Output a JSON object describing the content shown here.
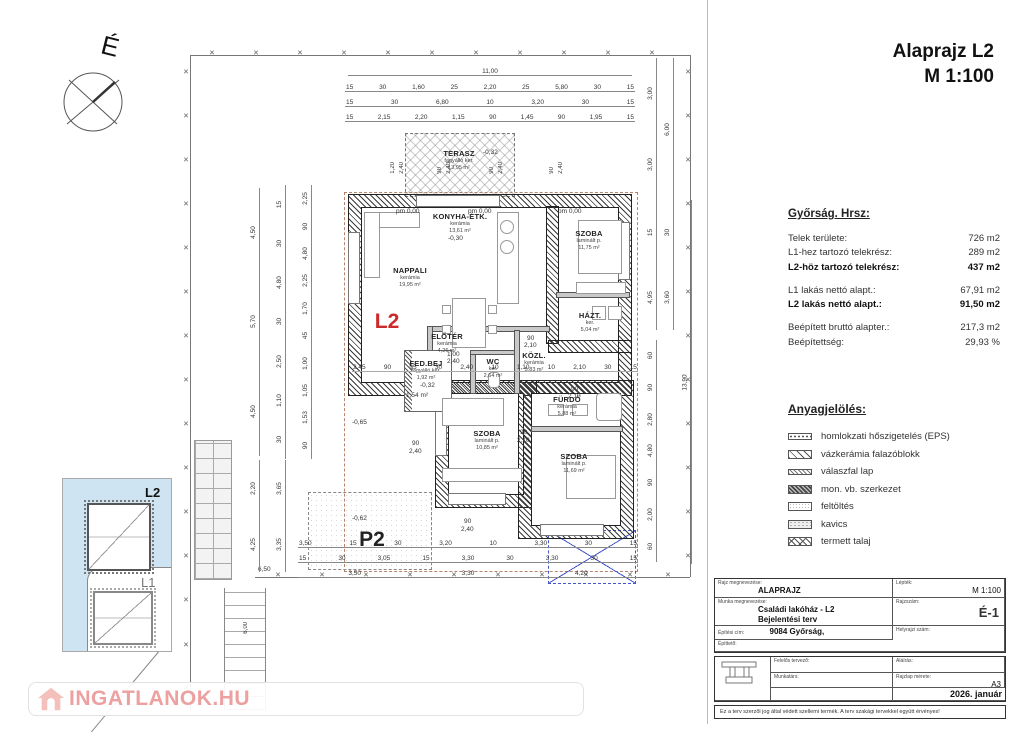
{
  "title": {
    "line1": "Alaprajz L2",
    "line2": "M 1:100"
  },
  "compass": {
    "north_label": "É"
  },
  "plan": {
    "unit_label": "L2",
    "parking_label": "P2",
    "rooms": [
      {
        "x": 459,
        "y": 160,
        "lines": [
          "TERASZ",
          "fagyálló ker.",
          "13,95 m²"
        ]
      },
      {
        "x": 410,
        "y": 277,
        "lines": [
          "NAPPALI",
          "kerámia",
          "19,95 m²"
        ]
      },
      {
        "x": 460,
        "y": 223,
        "lines": [
          "KONYHA-ÉTK.",
          "kerámia",
          "13,61 m²"
        ]
      },
      {
        "x": 589,
        "y": 240,
        "lines": [
          "SZOBA",
          "laminált p.",
          "11,75 m²"
        ]
      },
      {
        "x": 447,
        "y": 343,
        "lines": [
          "ELŐTÉR",
          "kerámia",
          "4,26 m²"
        ]
      },
      {
        "x": 534,
        "y": 362,
        "lines": [
          "KÖZL.",
          "kerámia",
          "5,83 m²"
        ]
      },
      {
        "x": 590,
        "y": 322,
        "lines": [
          "HÁZT.",
          "ker.",
          "5,04 m²"
        ]
      },
      {
        "x": 493,
        "y": 368,
        "lines": [
          "WC",
          "ker.",
          "2,64 m²"
        ]
      },
      {
        "x": 567,
        "y": 406,
        "lines": [
          "FÜRDŐ",
          "kerámia",
          "5,88 m²"
        ]
      },
      {
        "x": 487,
        "y": 440,
        "lines": [
          "SZOBA",
          "laminált p.",
          "10,85 m²"
        ]
      },
      {
        "x": 574,
        "y": 463,
        "lines": [
          "SZOBA",
          "laminált p.",
          "11,69 m²"
        ]
      },
      {
        "x": 426,
        "y": 370,
        "lines": [
          "FED.BEJ",
          "fagyálló ker.",
          "1,92 m²"
        ]
      }
    ],
    "floats": [
      {
        "t": "pm 0,00",
        "x": 396,
        "y": 209
      },
      {
        "t": "pm 0,00",
        "x": 468,
        "y": 209
      },
      {
        "t": "pm 0,00",
        "x": 558,
        "y": 209
      },
      {
        "t": "-0,30",
        "x": 448,
        "y": 236
      },
      {
        "t": "-0,32",
        "x": 483,
        "y": 150
      },
      {
        "t": "-0,32",
        "x": 420,
        "y": 383
      },
      {
        "t": "-0,65",
        "x": 352,
        "y": 420
      },
      {
        "t": "-0,62",
        "x": 352,
        "y": 516
      },
      {
        "t": "1,54 m²",
        "x": 406,
        "y": 393
      },
      {
        "t": "1,00",
        "x": 447,
        "y": 352
      },
      {
        "t": "2,40",
        "x": 447,
        "y": 359
      },
      {
        "t": "90",
        "x": 527,
        "y": 336
      },
      {
        "t": "2,10",
        "x": 524,
        "y": 343
      },
      {
        "t": "90",
        "x": 571,
        "y": 387
      },
      {
        "t": "2,10",
        "x": 568,
        "y": 394
      },
      {
        "t": "90",
        "x": 412,
        "y": 441
      },
      {
        "t": "2,40",
        "x": 409,
        "y": 449
      },
      {
        "t": "90",
        "x": 520,
        "y": 430
      },
      {
        "t": "2,10",
        "x": 517,
        "y": 438
      },
      {
        "t": "90",
        "x": 464,
        "y": 519
      },
      {
        "t": "2,40",
        "x": 461,
        "y": 527
      },
      {
        "t": "6,50",
        "x": 258,
        "y": 567
      },
      {
        "t": "1,20",
        "x": 390,
        "y": 162,
        "c": "vflt"
      },
      {
        "t": "2,40",
        "x": 399,
        "y": 162,
        "c": "vflt"
      },
      {
        "t": "90",
        "x": 437,
        "y": 167,
        "c": "vflt"
      },
      {
        "t": "2,40",
        "x": 446,
        "y": 162,
        "c": "vflt"
      },
      {
        "t": "90",
        "x": 489,
        "y": 167,
        "c": "vflt"
      },
      {
        "t": "2,40",
        "x": 498,
        "y": 162,
        "c": "vflt"
      },
      {
        "t": "90",
        "x": 549,
        "y": 167,
        "c": "vflt"
      },
      {
        "t": "2,40",
        "x": 558,
        "y": 162,
        "c": "vflt"
      },
      {
        "t": "6,00",
        "x": 243,
        "y": 622,
        "c": "vflt"
      }
    ],
    "boundary_marks": [
      {
        "t": "×",
        "x": 186,
        "y": 72
      },
      {
        "t": "×",
        "x": 186,
        "y": 116
      },
      {
        "t": "×",
        "x": 186,
        "y": 160
      },
      {
        "t": "×",
        "x": 186,
        "y": 204
      },
      {
        "t": "×",
        "x": 186,
        "y": 248
      },
      {
        "t": "×",
        "x": 186,
        "y": 292
      },
      {
        "t": "×",
        "x": 186,
        "y": 336
      },
      {
        "t": "×",
        "x": 186,
        "y": 380
      },
      {
        "t": "×",
        "x": 186,
        "y": 424
      },
      {
        "t": "×",
        "x": 186,
        "y": 468
      },
      {
        "t": "×",
        "x": 186,
        "y": 512
      },
      {
        "t": "×",
        "x": 186,
        "y": 556
      },
      {
        "t": "×",
        "x": 186,
        "y": 600
      },
      {
        "t": "×",
        "x": 186,
        "y": 645
      },
      {
        "t": "×",
        "x": 186,
        "y": 688
      },
      {
        "t": "×",
        "x": 212,
        "y": 53
      },
      {
        "t": "×",
        "x": 256,
        "y": 53
      },
      {
        "t": "×",
        "x": 300,
        "y": 53
      },
      {
        "t": "×",
        "x": 344,
        "y": 53
      },
      {
        "t": "×",
        "x": 388,
        "y": 53
      },
      {
        "t": "×",
        "x": 432,
        "y": 53
      },
      {
        "t": "×",
        "x": 476,
        "y": 53
      },
      {
        "t": "×",
        "x": 520,
        "y": 53
      },
      {
        "t": "×",
        "x": 564,
        "y": 53
      },
      {
        "t": "×",
        "x": 608,
        "y": 53
      },
      {
        "t": "×",
        "x": 652,
        "y": 53
      },
      {
        "t": "×",
        "x": 688,
        "y": 72
      },
      {
        "t": "×",
        "x": 688,
        "y": 116
      },
      {
        "t": "×",
        "x": 688,
        "y": 160
      },
      {
        "t": "×",
        "x": 688,
        "y": 204
      },
      {
        "t": "×",
        "x": 688,
        "y": 248
      },
      {
        "t": "×",
        "x": 688,
        "y": 292
      },
      {
        "t": "×",
        "x": 688,
        "y": 336
      },
      {
        "t": "×",
        "x": 688,
        "y": 380
      },
      {
        "t": "×",
        "x": 688,
        "y": 424
      },
      {
        "t": "×",
        "x": 688,
        "y": 468
      },
      {
        "t": "×",
        "x": 688,
        "y": 512
      },
      {
        "t": "×",
        "x": 688,
        "y": 556
      },
      {
        "t": "×",
        "x": 278,
        "y": 575
      },
      {
        "t": "×",
        "x": 322,
        "y": 575
      },
      {
        "t": "×",
        "x": 366,
        "y": 575
      },
      {
        "t": "×",
        "x": 410,
        "y": 575
      },
      {
        "t": "×",
        "x": 454,
        "y": 575
      },
      {
        "t": "×",
        "x": 498,
        "y": 575
      },
      {
        "t": "×",
        "x": 542,
        "y": 575
      },
      {
        "t": "×",
        "x": 586,
        "y": 575
      },
      {
        "t": "×",
        "x": 630,
        "y": 575
      },
      {
        "t": "×",
        "x": 668,
        "y": 575
      }
    ],
    "dims": {
      "top_total": [
        "11,00"
      ],
      "top_row1": [
        "15",
        "30",
        "1,60",
        "25",
        "2,20",
        "25",
        "5,80",
        "30",
        "15"
      ],
      "top_row2": [
        "15",
        "30",
        "6,80",
        "10",
        "3,20",
        "30",
        "15"
      ],
      "top_row3": [
        "15",
        "2,15",
        "2,20",
        "1,15",
        "90",
        "1,45",
        "90",
        "1,95",
        "15"
      ],
      "interior_row": [
        "2,45",
        "90",
        "95",
        "30",
        "2,40",
        "10",
        "1,10",
        "10",
        "2,10",
        "30",
        "15"
      ],
      "bottom_row1": [
        "3,50",
        "15",
        "30",
        "3,20",
        "10",
        "3,30",
        "30",
        "15"
      ],
      "bottom_row2": [
        "15",
        "30",
        "3,05",
        "15",
        "3,30",
        "30",
        "3,30",
        "30",
        "15"
      ],
      "bottom_row3": [
        "3,50",
        "3,30",
        "4,20"
      ],
      "left_a": [
        "4,50",
        "5,70",
        "4,50"
      ],
      "left_b": [
        "15",
        "30",
        "4,80",
        "30",
        "2,50",
        "1,10",
        "30"
      ],
      "left_c": [
        "2,25",
        "90",
        "4,80",
        "2,25",
        "1,70",
        "45",
        "1,00",
        "1,05",
        "1,53",
        "90"
      ],
      "left_lower_a": [
        "2,20",
        "4,25"
      ],
      "left_lower_b": [
        "3,65",
        "3,35"
      ],
      "right_a": [
        "3,00",
        "3,00"
      ],
      "right_b": [
        "6,00"
      ],
      "right_total": [
        "13,90"
      ],
      "right_c": [
        "15",
        "4,95"
      ],
      "right_d": [
        "30",
        "3,60"
      ],
      "right_e": [
        "60",
        "90",
        "2,80",
        "4,80",
        "90",
        "2,00",
        "60"
      ]
    }
  },
  "info_panel": {
    "heading": "Győrság. Hrsz:",
    "rows": [
      {
        "label": "Telek területe:",
        "value": "726 m2"
      },
      {
        "label": "L1-hez tartozó telekrész:",
        "value": "289 m2"
      },
      {
        "label": "L2-höz tartozó telekrész:",
        "value": "437 m2"
      },
      {
        "label": "L1 lakás nettó alapt.:",
        "value": "67,91 m2"
      },
      {
        "label": "L2 lakás nettó alapt.:",
        "value": "91,50 m2"
      },
      {
        "label": "Beépített bruttó alapter.:",
        "value": "217,3 m2"
      },
      {
        "label": "Beépítettség:",
        "value": "29,93 %"
      }
    ]
  },
  "legend": {
    "heading": "Anyagjelölés:",
    "items": [
      {
        "label": "homlokzati hőszigetelés (EPS)"
      },
      {
        "label": "vázkerámia falazóblokk"
      },
      {
        "label": "válaszfal lap"
      },
      {
        "label": "mon. vb. szerkezet"
      },
      {
        "label": "feltöltés"
      },
      {
        "label": "kavics"
      },
      {
        "label": "termett talaj"
      }
    ]
  },
  "key_plan": {
    "l2_label": "L2",
    "l1_label": "L1"
  },
  "title_block": {
    "drawing_label": "Rajz megnevezése:",
    "drawing_value": "ALAPRAJZ",
    "scale_label": "Lépték:",
    "scale_value": "M 1:100",
    "work_label": "Munka megnevezése:",
    "work_value1": "Családi lakóház - L2",
    "work_value2": "Bejelentési terv",
    "number_label": "Rajzszám:",
    "number_value": "É-1",
    "address_label": "Építési cím:",
    "address_value": "9084 Győrság,",
    "parcel_label": "Helyrajzi szám:",
    "client_label": "Építtető:",
    "designer_label": "Felelős tervező:",
    "signature_label": "Aláírás:",
    "collab_label": "Munkatárs:",
    "size_label": "Rajzlap mérete:",
    "size_value": "A3",
    "date_value": "2026. január",
    "footer": "Ez a terv szerzői jog által védett szellemi termék. A terv szakági tervekkel együtt érvényes!"
  },
  "watermark": {
    "text": "INGATLANOK.HU"
  }
}
